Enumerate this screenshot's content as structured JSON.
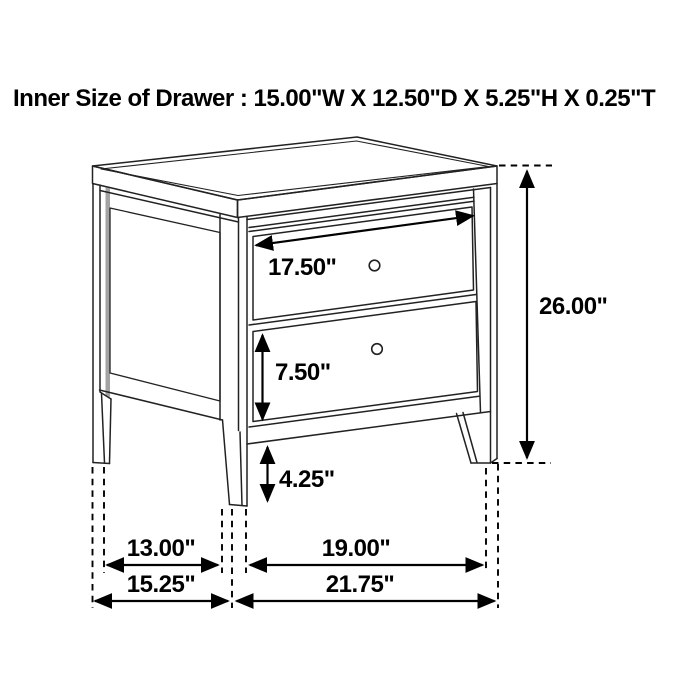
{
  "title": "Inner Size of Drawer : 15.00\"W X 12.50\"D X 5.25\"H X 0.25\"T",
  "inner_drawer_size": {
    "width": "15.00\"W",
    "depth": "12.50\"D",
    "height": "5.25\"H",
    "thickness": "0.25\"T"
  },
  "dimensions": {
    "top_drawer_width": "17.50\"",
    "bottom_drawer_front_height": "7.50\"",
    "leg_clearance_height": "4.25\"",
    "overall_height": "26.00\"",
    "side_leg_spacing": "13.00\"",
    "front_leg_spacing": "19.00\"",
    "overall_depth": "15.25\"",
    "overall_width": "21.75\""
  },
  "colors": {
    "line": "#000000",
    "furniture_line": "#222222",
    "background": "#ffffff",
    "panel_shadow_gray": "#a3a3a3"
  }
}
